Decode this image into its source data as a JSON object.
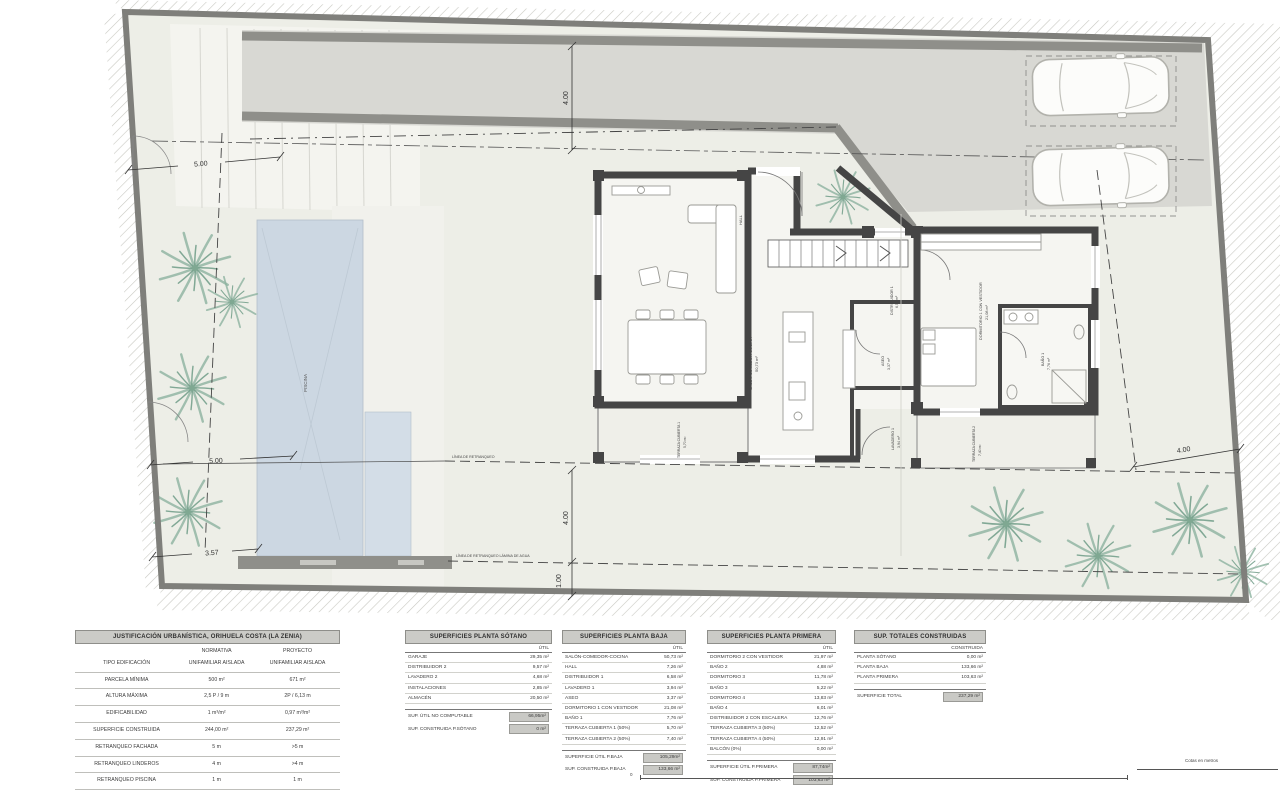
{
  "plan": {
    "dim": {
      "top": "4.00",
      "left_top": "5.00",
      "left_mid": "5.00",
      "left_bottom": "3.57",
      "water": "4.00",
      "pool": "1.00",
      "right": "4.00"
    },
    "lines": {
      "retranqueo": "LÍNEA DE RETRANQUEO",
      "agua": "LÍNEA DE RETRANQUEO LÁMINA DE AGUA"
    },
    "pool_label": "PISCINA",
    "scale_note": "Cotas en metros",
    "scale_zero": "0",
    "rooms": {
      "salon": "SALÓN-COMEDOR-COCINA",
      "salon_area": "50,73 m²",
      "hall": "HALL",
      "hall_area": "7,26 m²",
      "distribuidor": "DISTRIBUIDOR 1",
      "distribuidor_area": "6,58 m²",
      "aseo": "ASEO",
      "aseo_area": "3,37 m²",
      "lavadero": "LAVADERO 1",
      "lavadero_area": "3,94 m²",
      "dormitorio": "DORMITORIO 1 CON VESTIDOR",
      "dormitorio_area": "21,08 m²",
      "bano": "BAÑO 1",
      "bano_area": "7,76 m²",
      "terraza1": "TERRAZA CUBIERTA 1",
      "terraza1_area": "5,70 m²",
      "terraza2": "TERRAZA CUBIERTA 2",
      "terraza2_area": "7,40 m²"
    },
    "colors": {
      "pool": "#ccd7e2",
      "wall": "#454545",
      "boundary": "#7f7f7b",
      "driveway": "#d8d8d3",
      "palm": "#8db3a0"
    }
  },
  "tables": {
    "urbanistica": {
      "title": "JUSTIFICACIÓN URBANÍSTICA, ORIHUELA COSTA (LA ZENIA)",
      "col1": "NORMATIVA",
      "col2": "PROYECTO",
      "rows": [
        {
          "label": "TIPO EDIFICACIÓN",
          "v1": "UNIFAMILIAR AISLADA",
          "v2": "UNIFAMILIAR AISLADA"
        },
        {
          "label": "PARCELA MÍNIMA",
          "v1": "500 m²",
          "v2": "671 m²"
        },
        {
          "label": "ALTURA MÁXIMA",
          "v1": "2,5 P / 9 m",
          "v2": "2P / 6,13 m"
        },
        {
          "label": "EDIFICABILIDAD",
          "v1": "1 m³/m²",
          "v2": "0,97 m³/m²"
        },
        {
          "label": "SUPERFICIE CONSTRUIDA",
          "v1": "244,00 m²",
          "v2": "237,29 m²"
        },
        {
          "label": "RETRANQUEO FACHADA",
          "v1": "5 m",
          "v2": ">5 m"
        },
        {
          "label": "RETRANQUEO LINDEROS",
          "v1": "4 m",
          "v2": ">4 m"
        },
        {
          "label": "RETRANQUEO PISCINA",
          "v1": "1 m",
          "v2": "1 m"
        }
      ]
    },
    "sotano": {
      "title": "SUPERFICIES PLANTA SÓTANO",
      "col": "ÚTIL",
      "rows": [
        {
          "label": "GARAJE",
          "value": "29,35 m²"
        },
        {
          "label": "DISTRIBUIDOR 2",
          "value": "9,57 m²"
        },
        {
          "label": "LAVADERO 2",
          "value": "4,68 m²"
        },
        {
          "label": "INSTALACIONES",
          "value": "2,85 m²"
        },
        {
          "label": "ALMACÉN",
          "value": "20,50 m²"
        }
      ],
      "totals": [
        {
          "label": "SUP. ÚTIL NO COMPUTABLE",
          "value": "66,95m²"
        },
        {
          "label": "SUP. CONSTRUIDA P.SÓTANO",
          "value": "0 m²"
        }
      ]
    },
    "baja": {
      "title": "SUPERFICIES PLANTA BAJA",
      "col": "ÚTIL",
      "rows": [
        {
          "label": "SALÓN-COMEDOR-COCINA",
          "value": "50,73 m²"
        },
        {
          "label": "HALL",
          "value": "7,26 m²"
        },
        {
          "label": "DISTRIBUIDOR 1",
          "value": "6,58 m²"
        },
        {
          "label": "LAVADERO 1",
          "value": "3,94 m²"
        },
        {
          "label": "ASEO",
          "value": "3,37 m²"
        },
        {
          "label": "DORMITORIO 1 CON VESTIDOR",
          "value": "21,08 m²"
        },
        {
          "label": "BAÑO 1",
          "value": "7,76 m²"
        },
        {
          "label": "TERRAZA CUBIERTA 1 (50%)",
          "value": "5,70 m²"
        },
        {
          "label": "TERRAZA CUBIERTA 2 (50%)",
          "value": "7,40 m²"
        }
      ],
      "totals": [
        {
          "label": "SUPERFICIE ÚTIL P.BAJA",
          "value": "105,29m²"
        },
        {
          "label": "SUP. CONSTRUIDA P.BAJA",
          "value": "133,66 m²"
        }
      ]
    },
    "primera": {
      "title": "SUPERFICIES PLANTA PRIMERA",
      "col": "ÚTIL",
      "rows": [
        {
          "label": "DORMITORIO 2 CON VESTIDOR",
          "value": "21,97 m²"
        },
        {
          "label": "BAÑO 2",
          "value": "4,88 m²"
        },
        {
          "label": "DORMITORIO 3",
          "value": "11,78 m²"
        },
        {
          "label": "BAÑO 3",
          "value": "5,22 m²"
        },
        {
          "label": "DORMITORIO 4",
          "value": "13,83 m²"
        },
        {
          "label": "BAÑO 4",
          "value": "6,01 m²"
        },
        {
          "label": "DISTRIBUIDOR 2 CON ESCALERA",
          "value": "12,76 m²"
        },
        {
          "label": "TERRAZA CUBIERTA 3 (50%)",
          "value": "12,52 m²"
        },
        {
          "label": "TERRAZA CUBIERTA 4 (50%)",
          "value": "12,91 m²"
        },
        {
          "label": "BALCÓN (0%)",
          "value": "0,00 m²"
        }
      ],
      "totals": [
        {
          "label": "SUPERFICIE ÚTIL P.PRIMERA",
          "value": "87,74m²"
        },
        {
          "label": "SUP. CONSTRUIDA P.PRIMERA",
          "value": "103,63 m²"
        }
      ]
    },
    "totales": {
      "title": "SUP. TOTALES CONSTRUIDAS",
      "col": "CONSTRUIDA",
      "rows": [
        {
          "label": "PLANTA SÓTANO",
          "value": "0,00 m²"
        },
        {
          "label": "PLANTA BAJA",
          "value": "133,66 m²"
        },
        {
          "label": "PLANTA PRIMERA",
          "value": "103,63 m²"
        }
      ],
      "totals": [
        {
          "label": "SUPERFICIE TOTAL",
          "value": "237,29 m²"
        }
      ]
    }
  }
}
